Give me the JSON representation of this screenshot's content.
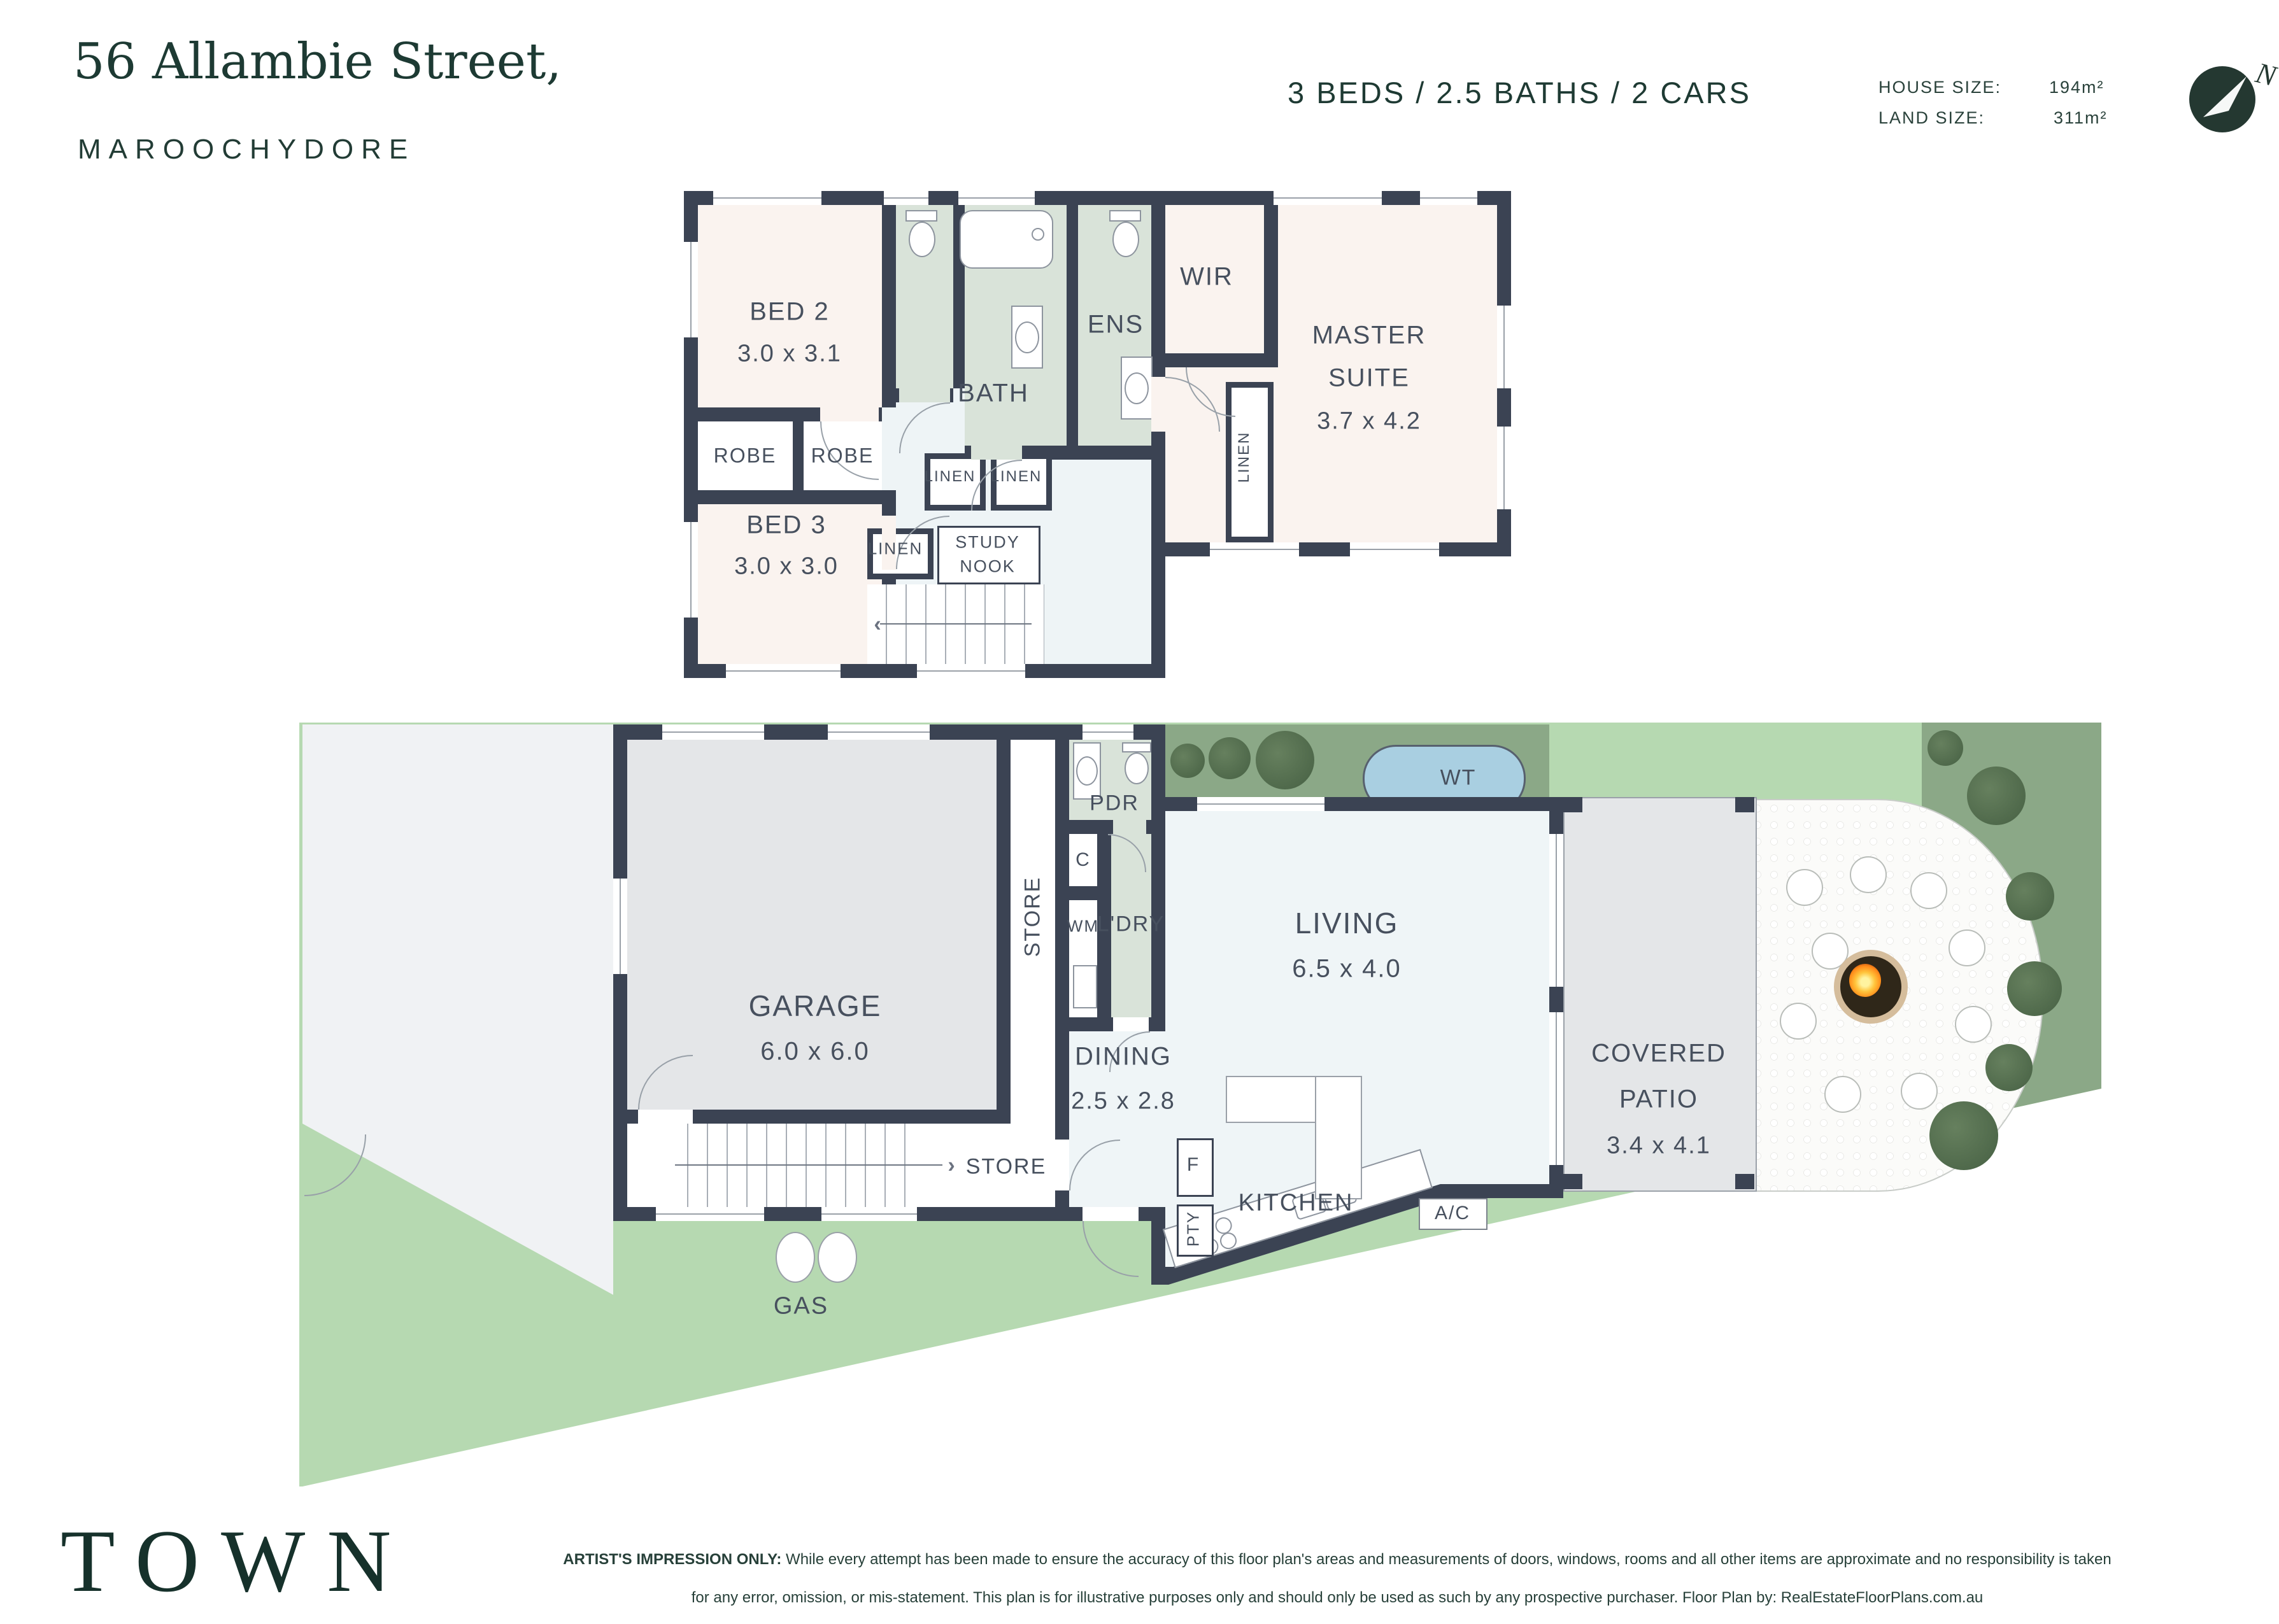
{
  "header": {
    "street": "56 Allambie Street,",
    "suburb": "MAROOCHYDORE",
    "summary": "3 BEDS / 2.5 BATHS / 2 CARS",
    "house_size_label": "HOUSE SIZE:",
    "house_size_value": "194m²",
    "land_size_label": "LAND SIZE:",
    "land_size_value": "311m²",
    "compass_n": "N"
  },
  "upper_floor": {
    "bed2_name": "BED 2",
    "bed2_dims": "3.0 x 3.1",
    "bath": "BATH",
    "ens": "ENS",
    "wir": "WIR",
    "master_1": "MASTER",
    "master_2": "SUITE",
    "master_dims": "3.7 x 4.2",
    "robe_1": "ROBE",
    "robe_2": "ROBE",
    "linen_1": "LINEN",
    "linen_2": "LINEN",
    "linen_wir": "LINEN",
    "linen_hall": "LINEN",
    "study_1": "STUDY",
    "study_2": "NOOK",
    "bed3_name": "BED 3",
    "bed3_dims": "3.0 x 3.0",
    "stairs_arrow": "‹"
  },
  "ground_floor": {
    "garage_name": "GARAGE",
    "garage_dims": "6.0 x 6.0",
    "store_tall": "STORE",
    "cupboard": "C",
    "wm": "WM",
    "pdr": "PDR",
    "ldry": "L'DRY",
    "wt": "WT",
    "dining_name": "DINING",
    "dining_dims": "2.5 x 2.8",
    "living_name": "LIVING",
    "living_dims": "6.5 x 4.0",
    "kitchen": "KITCHEN",
    "fridge": "F",
    "pantry": "PTY",
    "ac": "A/C",
    "patio_1": "COVERED",
    "patio_2": "PATIO",
    "patio_dims": "3.4 x 4.1",
    "store_under_stairs": "STORE",
    "stairs_arrow": "›",
    "gas": "GAS"
  },
  "footer": {
    "logo": "TOWN",
    "disclaimer_bold": "ARTIST'S IMPRESSION ONLY:",
    "disclaimer_rest": " While every attempt has been made to ensure the accuracy of this floor plan's areas and measurements of doors, windows, rooms and all other items are approximate and no responsibility is taken for any error, omission, or mis-statement. This plan is for illustrative purposes only and should only be used as such by any prospective purchaser. Floor Plan by: RealEstateFloorPlans.com.au"
  },
  "colors": {
    "wall": "#3b4353",
    "brand_green": "#1d3a33",
    "lawn": "#b6d9b1",
    "garden_bed": "#8ba887",
    "wet_area": "#d9e3d9",
    "bedroom": "#faf3ef",
    "hall": "#eef4f6",
    "hard_floor": "#e4e6e8",
    "water_tank": "#a9cfe1"
  }
}
